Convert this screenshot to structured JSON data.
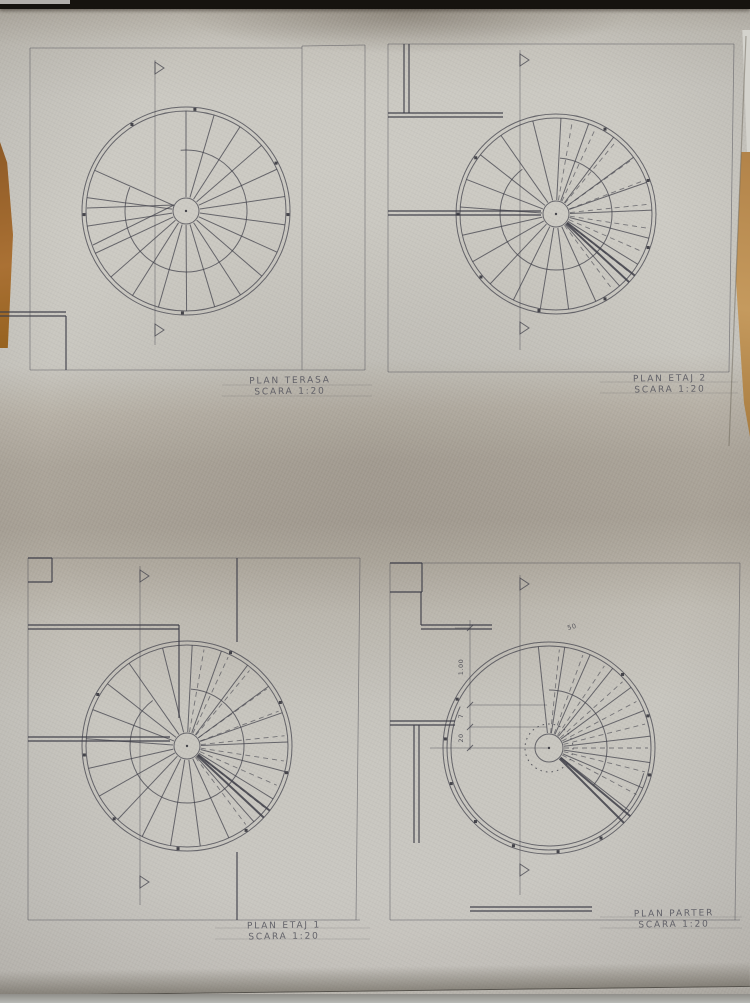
{
  "photo": {
    "paper_color": "#cac8c1",
    "shadow_band_color": "#a7a095",
    "ink_color": "#3e3e48",
    "table_wood_color": "#aa7134",
    "top_strip_color": "#16130f"
  },
  "plans": [
    {
      "id": "terasa",
      "label": "PLAN TERASA",
      "scale": "SCARA 1:20",
      "frame": [
        [
          30,
          48,
          30,
          370
        ],
        [
          30,
          48,
          302,
          48
        ],
        [
          302,
          46,
          302,
          370
        ],
        [
          365,
          45,
          365,
          370
        ],
        [
          30,
          370,
          365,
          370
        ],
        [
          302,
          46,
          365,
          45
        ]
      ],
      "walls": [
        [
          0,
          312,
          66,
          312
        ],
        [
          0,
          316,
          66,
          316
        ],
        [
          66,
          316,
          66,
          370
        ]
      ],
      "extra": [
        [
          87,
          208,
          174,
          205
        ],
        [
          93,
          245,
          174,
          205
        ]
      ],
      "stair": {
        "cx": 186,
        "cy": 211,
        "rims": [
          104,
          100
        ],
        "rInner": 13,
        "midR": 61,
        "midA": [
          -95,
          203
        ],
        "treadA0": -90,
        "treadA1": 204,
        "treadN": 18
      },
      "section": {
        "x": 155,
        "y1": 60,
        "y2": 345,
        "flags": [
          62,
          324
        ]
      },
      "rimDots": [
        -85,
        -122,
        -28,
        2,
        178,
        92
      ]
    },
    {
      "id": "etaj-2",
      "label": "PLAN ETAJ 2",
      "scale": "SCARA 1:20",
      "frame": [
        [
          388,
          44,
          388,
          372
        ],
        [
          388,
          44,
          734,
          44
        ],
        [
          734,
          44,
          729,
          372
        ],
        [
          388,
          372,
          729,
          372
        ]
      ],
      "walls": [
        [
          388,
          113,
          503,
          113
        ],
        [
          388,
          117,
          503,
          117
        ],
        [
          404,
          44,
          404,
          113
        ],
        [
          409,
          44,
          409,
          113
        ],
        [
          388,
          211,
          541,
          211
        ],
        [
          388,
          215,
          541,
          215
        ]
      ],
      "extra": [],
      "stair": {
        "cx": 556,
        "cy": 214,
        "rims": [
          100,
          96
        ],
        "rInner": 13,
        "midR": 56,
        "midA": [
          -86,
          233
        ],
        "treadA0": -104,
        "treadA1": 235,
        "treadN": 20,
        "dash": [
          -80,
          54,
          14.8
        ],
        "heavy": [
          38,
          43
        ]
      },
      "section": {
        "x": 520,
        "y1": 50,
        "y2": 350,
        "flags": [
          54,
          322
        ]
      },
      "rimDots": [
        -60,
        -20,
        20,
        60,
        100,
        140,
        180,
        215
      ]
    },
    {
      "id": "etaj-1",
      "label": "PLAN ETAJ 1",
      "scale": "SCARA 1:20",
      "frame": [
        [
          28,
          558,
          28,
          920
        ],
        [
          28,
          558,
          360,
          558
        ],
        [
          360,
          558,
          356,
          920
        ],
        [
          28,
          920,
          360,
          920
        ]
      ],
      "walls": [
        [
          28,
          625,
          179,
          625
        ],
        [
          28,
          629,
          179,
          629
        ],
        [
          179,
          625,
          179,
          718
        ],
        [
          28,
          737,
          170,
          737
        ],
        [
          28,
          741,
          170,
          741
        ],
        [
          28,
          558,
          52,
          558
        ],
        [
          52,
          558,
          52,
          582
        ],
        [
          28,
          582,
          52,
          582
        ],
        [
          237,
          558,
          237,
          642
        ],
        [
          237,
          852,
          237,
          920
        ]
      ],
      "extra": [],
      "stair": {
        "cx": 187,
        "cy": 746,
        "rims": [
          105,
          101
        ],
        "rInner": 13,
        "midR": 57,
        "midA": [
          -86,
          233
        ],
        "treadA0": -104,
        "treadA1": 235,
        "treadN": 20,
        "dash": [
          -80,
          54,
          14.8
        ],
        "heavy": [
          38,
          43
        ]
      },
      "section": {
        "x": 140,
        "y1": 566,
        "y2": 905,
        "flags": [
          570,
          876
        ]
      },
      "rimDots": [
        -65,
        -25,
        15,
        55,
        95,
        135,
        175,
        210
      ]
    },
    {
      "id": "parter",
      "label": "PLAN PARTER",
      "scale": "SCARA 1:20",
      "frame": [
        [
          390,
          563,
          390,
          920
        ],
        [
          390,
          563,
          740,
          563
        ],
        [
          740,
          563,
          735,
          920
        ],
        [
          390,
          920,
          740,
          920
        ]
      ],
      "walls": [
        [
          390,
          563,
          422,
          563
        ],
        [
          422,
          563,
          422,
          592
        ],
        [
          390,
          592,
          422,
          592
        ],
        [
          421,
          592,
          421,
          625
        ],
        [
          421,
          625,
          492,
          625
        ],
        [
          421,
          629,
          492,
          629
        ],
        [
          390,
          721,
          455,
          721
        ],
        [
          390,
          725,
          455,
          725
        ],
        [
          414,
          725,
          414,
          843
        ],
        [
          419,
          725,
          419,
          843
        ],
        [
          470,
          907,
          592,
          907
        ],
        [
          470,
          911,
          592,
          911
        ]
      ],
      "extra": [
        [
          470,
          620,
          470,
          750,
          "thin"
        ],
        [
          467,
          631,
          473,
          625,
          ""
        ],
        [
          467,
          708,
          473,
          702,
          ""
        ],
        [
          467,
          730,
          473,
          724,
          ""
        ],
        [
          467,
          751,
          473,
          745,
          ""
        ],
        [
          470,
          705,
          547,
          705,
          "thin"
        ],
        [
          470,
          727,
          547,
          727,
          "thin"
        ],
        [
          430,
          748,
          549,
          748,
          "thin"
        ],
        [
          455,
          628,
          470,
          628,
          "thin"
        ]
      ],
      "stair": {
        "cx": 549,
        "cy": 748,
        "rims": [
          106,
          102
        ],
        "rimArc": {
          "r": 98,
          "a0": 15,
          "a1": 205
        },
        "rInner": 14,
        "dotR": 24,
        "midR": 58,
        "midA": [
          -90,
          40
        ],
        "treadA0": -96,
        "treadA1": 38,
        "treadN": 9,
        "dash": [
          -84,
          32,
          14
        ],
        "heavy": [
          40,
          45
        ]
      },
      "section": {
        "x": 520,
        "y1": 575,
        "y2": 895,
        "flags": [
          578,
          864
        ]
      },
      "rimDots": [
        15,
        -18,
        -45,
        60,
        85,
        110,
        135,
        160,
        185,
        208
      ]
    }
  ],
  "dimensions": [
    {
      "text": "1.00",
      "x": 461,
      "y": 667,
      "rot": -90
    },
    {
      "text": "7",
      "x": 461,
      "y": 716,
      "rot": -90
    },
    {
      "text": "20",
      "x": 461,
      "y": 738,
      "rot": -90
    },
    {
      "text": "50",
      "x": 572,
      "y": 627,
      "rot": -15
    }
  ],
  "guides": [
    [
      222,
      385,
      372,
      385
    ],
    [
      222,
      396,
      372,
      396
    ],
    [
      600,
      382,
      738,
      382
    ],
    [
      600,
      393,
      738,
      393
    ],
    [
      215,
      928,
      370,
      928
    ],
    [
      215,
      939,
      370,
      939
    ],
    [
      600,
      917,
      742,
      917
    ],
    [
      600,
      928,
      742,
      928
    ]
  ],
  "paper_edges": [
    [
      746,
      36,
      729,
      446
    ]
  ]
}
